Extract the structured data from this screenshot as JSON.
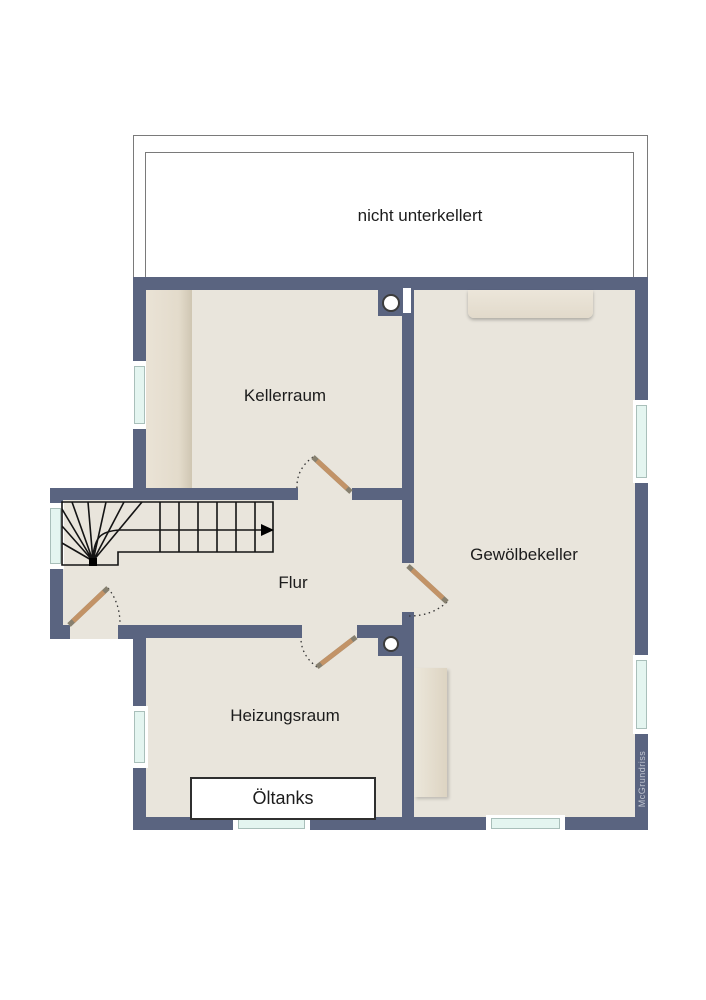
{
  "labels": {
    "not_basement": "nicht unterkellert",
    "kellerraum": "Kellerraum",
    "gewoelbekeller": "Gewölbekeller",
    "flur": "Flur",
    "heizungsraum": "Heizungsraum",
    "oeltanks": "Öltanks",
    "watermark": "McGrundriss"
  },
  "colors": {
    "wall": "#5a6480",
    "floor": "#e9e5dc",
    "glass": "#e4f5f0",
    "outline": "#7a7a7a",
    "door_leaf": "#c29367",
    "door_tip": "#87806f",
    "stair_line": "#141414",
    "watermark": "#c2c6d0",
    "furniture_light": "#ece6da",
    "furniture_dark": "#d8cfbd"
  },
  "features": {
    "floor_type": "basement plan",
    "windows": 7,
    "doors": 4,
    "chimney_flues": 2,
    "stairs": "winder staircase, arrow pointing right (up)"
  }
}
